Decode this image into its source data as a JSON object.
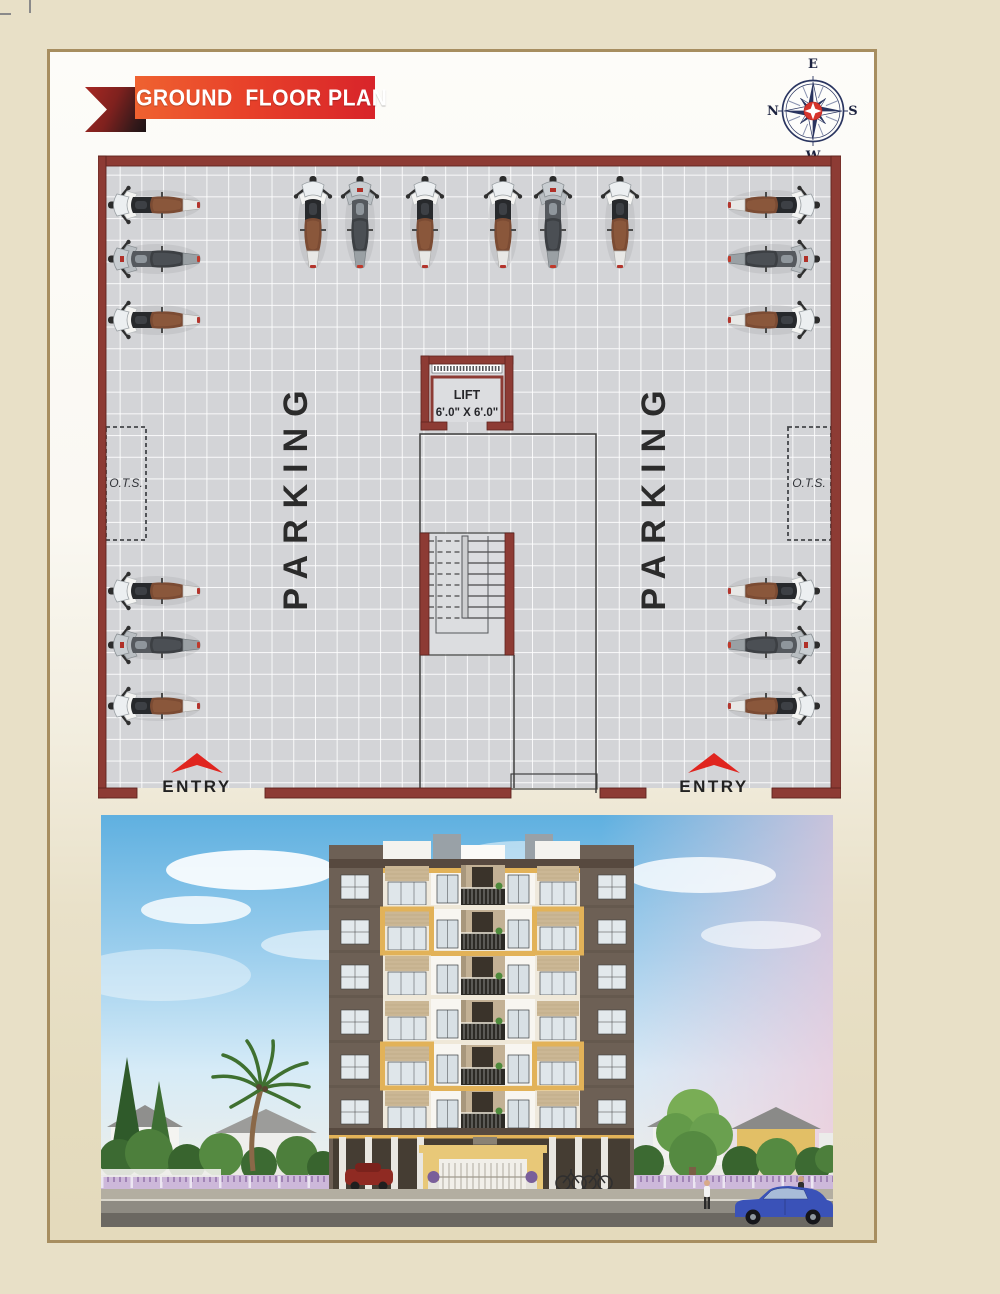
{
  "page": {
    "title": "GROUND  FLOOR PLAN"
  },
  "compass": {
    "top": "E",
    "left": "N",
    "right": "S",
    "bottom": "W"
  },
  "floor_plan": {
    "parking_left": "PARKING",
    "parking_right": "PARKING",
    "lift": {
      "label": "LIFT",
      "size": "6'.0\" X 6'.0\""
    },
    "ots_left": "O.T.S.",
    "ots_right": "O.T.S.",
    "entry_left": "ENTRY",
    "entry_right": "ENTRY",
    "bikes": [
      {
        "x": 215,
        "y": 70,
        "rot": 0,
        "variant": "brown"
      },
      {
        "x": 262,
        "y": 70,
        "rot": 0,
        "variant": "gray"
      },
      {
        "x": 327,
        "y": 70,
        "rot": 0,
        "variant": "brown"
      },
      {
        "x": 405,
        "y": 70,
        "rot": 0,
        "variant": "brown"
      },
      {
        "x": 455,
        "y": 70,
        "rot": 0,
        "variant": "gray"
      },
      {
        "x": 522,
        "y": 70,
        "rot": 0,
        "variant": "brown"
      },
      {
        "x": 57,
        "y": 52,
        "rot": -90,
        "variant": "brown"
      },
      {
        "x": 57,
        "y": 106,
        "rot": -90,
        "variant": "gray"
      },
      {
        "x": 57,
        "y": 167,
        "rot": -90,
        "variant": "brown"
      },
      {
        "x": 57,
        "y": 438,
        "rot": -90,
        "variant": "brown"
      },
      {
        "x": 57,
        "y": 492,
        "rot": -90,
        "variant": "gray"
      },
      {
        "x": 57,
        "y": 553,
        "rot": -90,
        "variant": "brown"
      },
      {
        "x": 675,
        "y": 52,
        "rot": 90,
        "variant": "brown"
      },
      {
        "x": 675,
        "y": 106,
        "rot": 90,
        "variant": "gray"
      },
      {
        "x": 675,
        "y": 167,
        "rot": 90,
        "variant": "brown"
      },
      {
        "x": 675,
        "y": 438,
        "rot": 90,
        "variant": "brown"
      },
      {
        "x": 675,
        "y": 492,
        "rot": 90,
        "variant": "gray"
      },
      {
        "x": 675,
        "y": 553,
        "rot": 90,
        "variant": "brown"
      }
    ]
  },
  "colors": {
    "wall_maroon": "#8d3b34",
    "tile_gray": "#d3d4d7",
    "entry_red": "#e0251f",
    "ribbon_orange": "#ef6230",
    "ribbon_red": "#d8242a",
    "compass_navy": "#2a3560",
    "compass_red": "#d5342c",
    "page_border_tan": "#a78e60",
    "background_cream": "#e8e0c7",
    "building_brown": "#6d6055",
    "building_gold": "#e2b258",
    "sky_blue": "#5fb0e0",
    "fence_lavender": "#cdb8da",
    "car_blue": "#3a52b8"
  }
}
